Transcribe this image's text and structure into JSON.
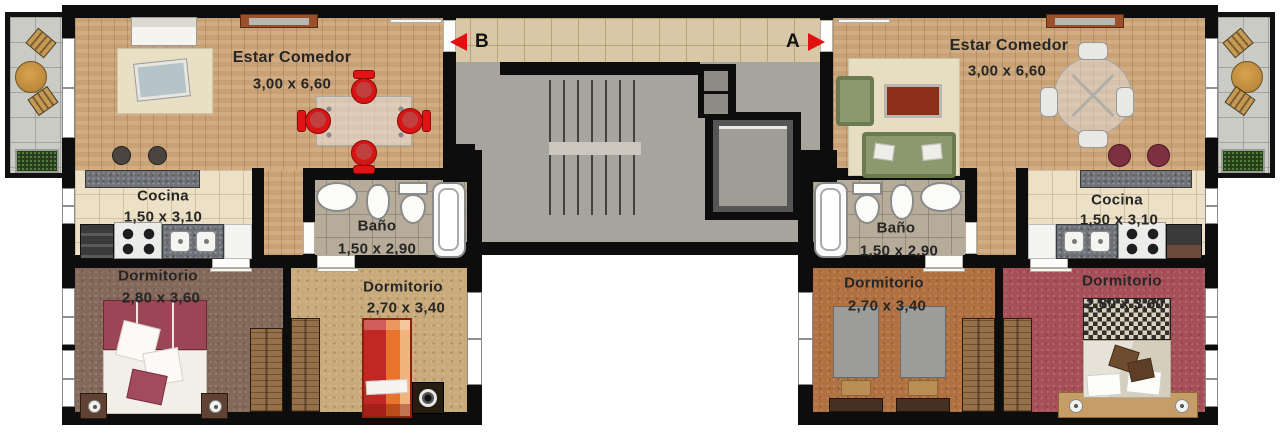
{
  "plan": {
    "markers": {
      "b": "B",
      "a": "A"
    },
    "unit_left": {
      "living": {
        "name": "Estar Comedor",
        "dims": "3,00 x 6,60"
      },
      "kitchen": {
        "name": "Cocina",
        "dims": "1,50 x 3,10"
      },
      "bath": {
        "name": "Baño",
        "dims": "1,50 x 2,90"
      },
      "bedroom_main": {
        "name": "Dormitorio",
        "dims": "2,80 x 3,60"
      },
      "bedroom_second": {
        "name": "Dormitorio",
        "dims": "2,70 x 3,40"
      }
    },
    "unit_right": {
      "living": {
        "name": "Estar Comedor",
        "dims": "3,00 x 6,60"
      },
      "kitchen": {
        "name": "Cocina",
        "dims": "1,50 x 3,10"
      },
      "bath": {
        "name": "Baño",
        "dims": "1,50 x 2,90"
      },
      "bedroom_second": {
        "name": "Dormitorio",
        "dims": "2,70 x 3,40"
      },
      "bedroom_main": {
        "name": "Dormitorio",
        "dims": "2,80 x 3,60"
      }
    },
    "colors": {
      "wall": "#0d0d0d",
      "wood_floor": "#cfa87c",
      "hall_tile": "#d9c8a5",
      "stair_floor": "#a7a39d",
      "marker_red": "#e21111"
    }
  }
}
